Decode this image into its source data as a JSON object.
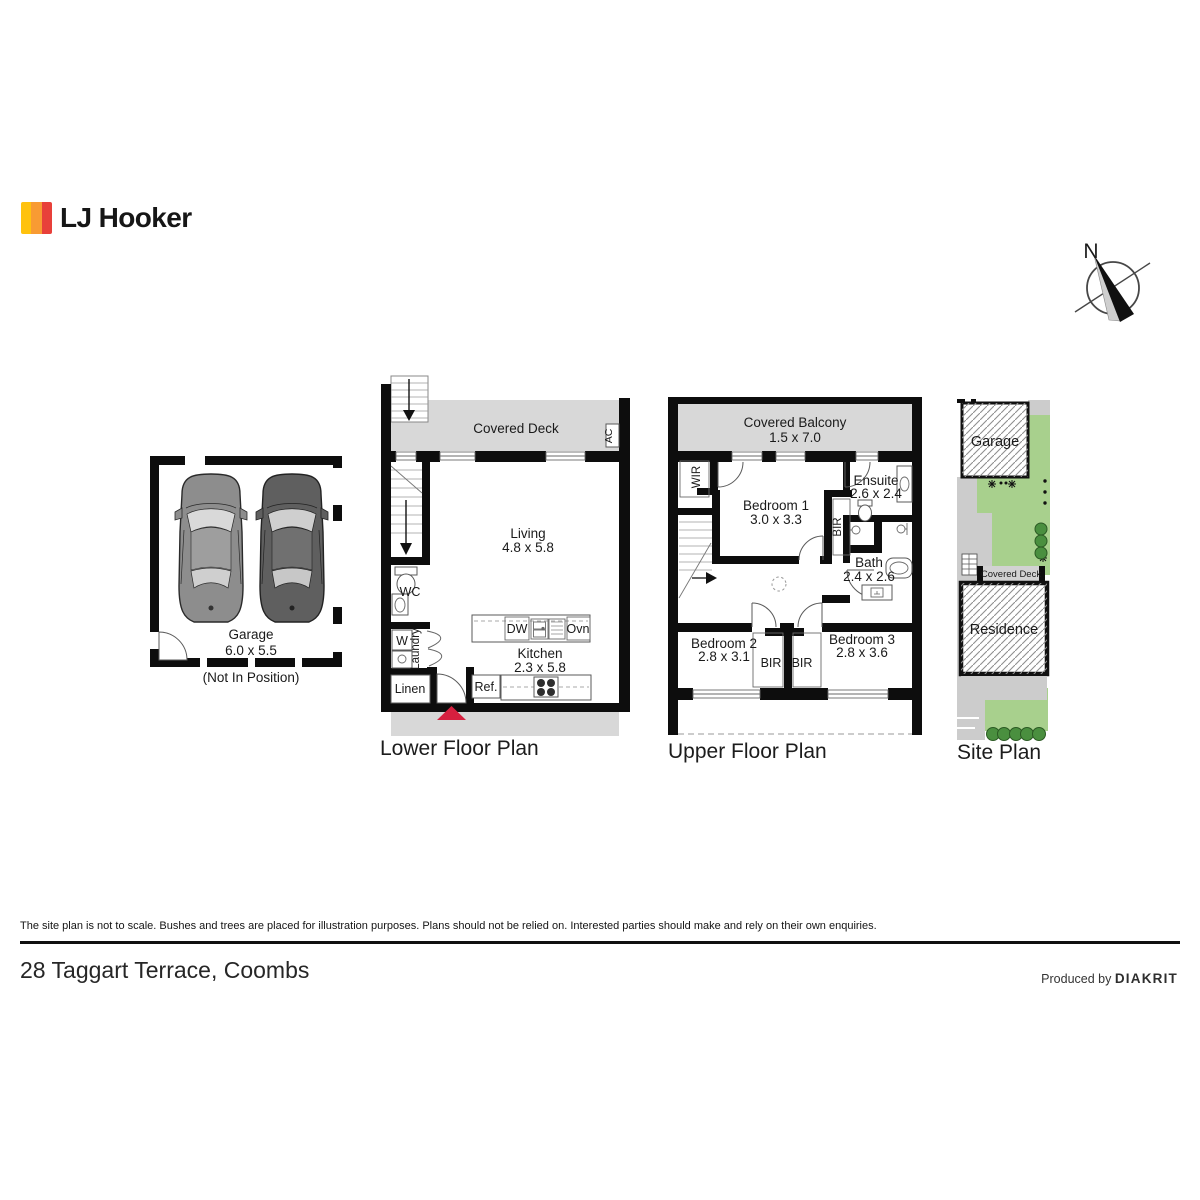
{
  "brand": {
    "name": "LJ Hooker",
    "bar_colors": [
      "#FFC20E",
      "#F89B33",
      "#E8403A"
    ]
  },
  "compass": {
    "north": "N"
  },
  "garage_plan": {
    "name": "Garage",
    "dims": "6.0 x 5.5",
    "note": "(Not In Position)"
  },
  "lower": {
    "title": "Lower Floor Plan",
    "deck": "Covered Deck",
    "ac": "AC",
    "living": "Living",
    "living_dims": "4.8 x 5.8",
    "wc": "WC",
    "washer": "W",
    "laundry": "Laundry",
    "linen": "Linen",
    "dw": "DW",
    "oven": "Ovn",
    "fridge": "Ref.",
    "kitchen": "Kitchen",
    "kitchen_dims": "2.3 x 5.8"
  },
  "upper": {
    "title": "Upper Floor Plan",
    "balcony": "Covered Balcony",
    "balcony_dims": "1.5 x 7.0",
    "wir": "WIR",
    "bed1": "Bedroom 1",
    "bed1_dims": "3.0 x 3.3",
    "ensuite": "Ensuite",
    "ensuite_dims": "2.6 x 2.4",
    "bir": "BIR",
    "bath": "Bath",
    "bath_dims": "2.4 x 2.6",
    "bed2": "Bedroom 2",
    "bed2_dims": "2.8 x 3.1",
    "bed3": "Bedroom 3",
    "bed3_dims": "2.8 x 3.6",
    "bir_left": "BIR",
    "bir_right": "BIR"
  },
  "site": {
    "title": "Site Plan",
    "garage": "Garage",
    "deck": "Covered Deck",
    "residence": "Residence"
  },
  "footer": {
    "disclaimer": "The site plan is not to scale. Bushes and trees are placed for illustration purposes. Plans should not be relied on. Interested parties should make and rely on their own enquiries.",
    "address": "28 Taggart Terrace, Coombs",
    "produced_by": "Produced by",
    "producer": "DIAKRIT"
  },
  "colors": {
    "wall": "#0d0d0d",
    "deck_gray": "#d8d8d8",
    "lawn_green": "#a8d08d",
    "tree_green": "#4a8f3f",
    "entry_red": "#d6203f"
  }
}
